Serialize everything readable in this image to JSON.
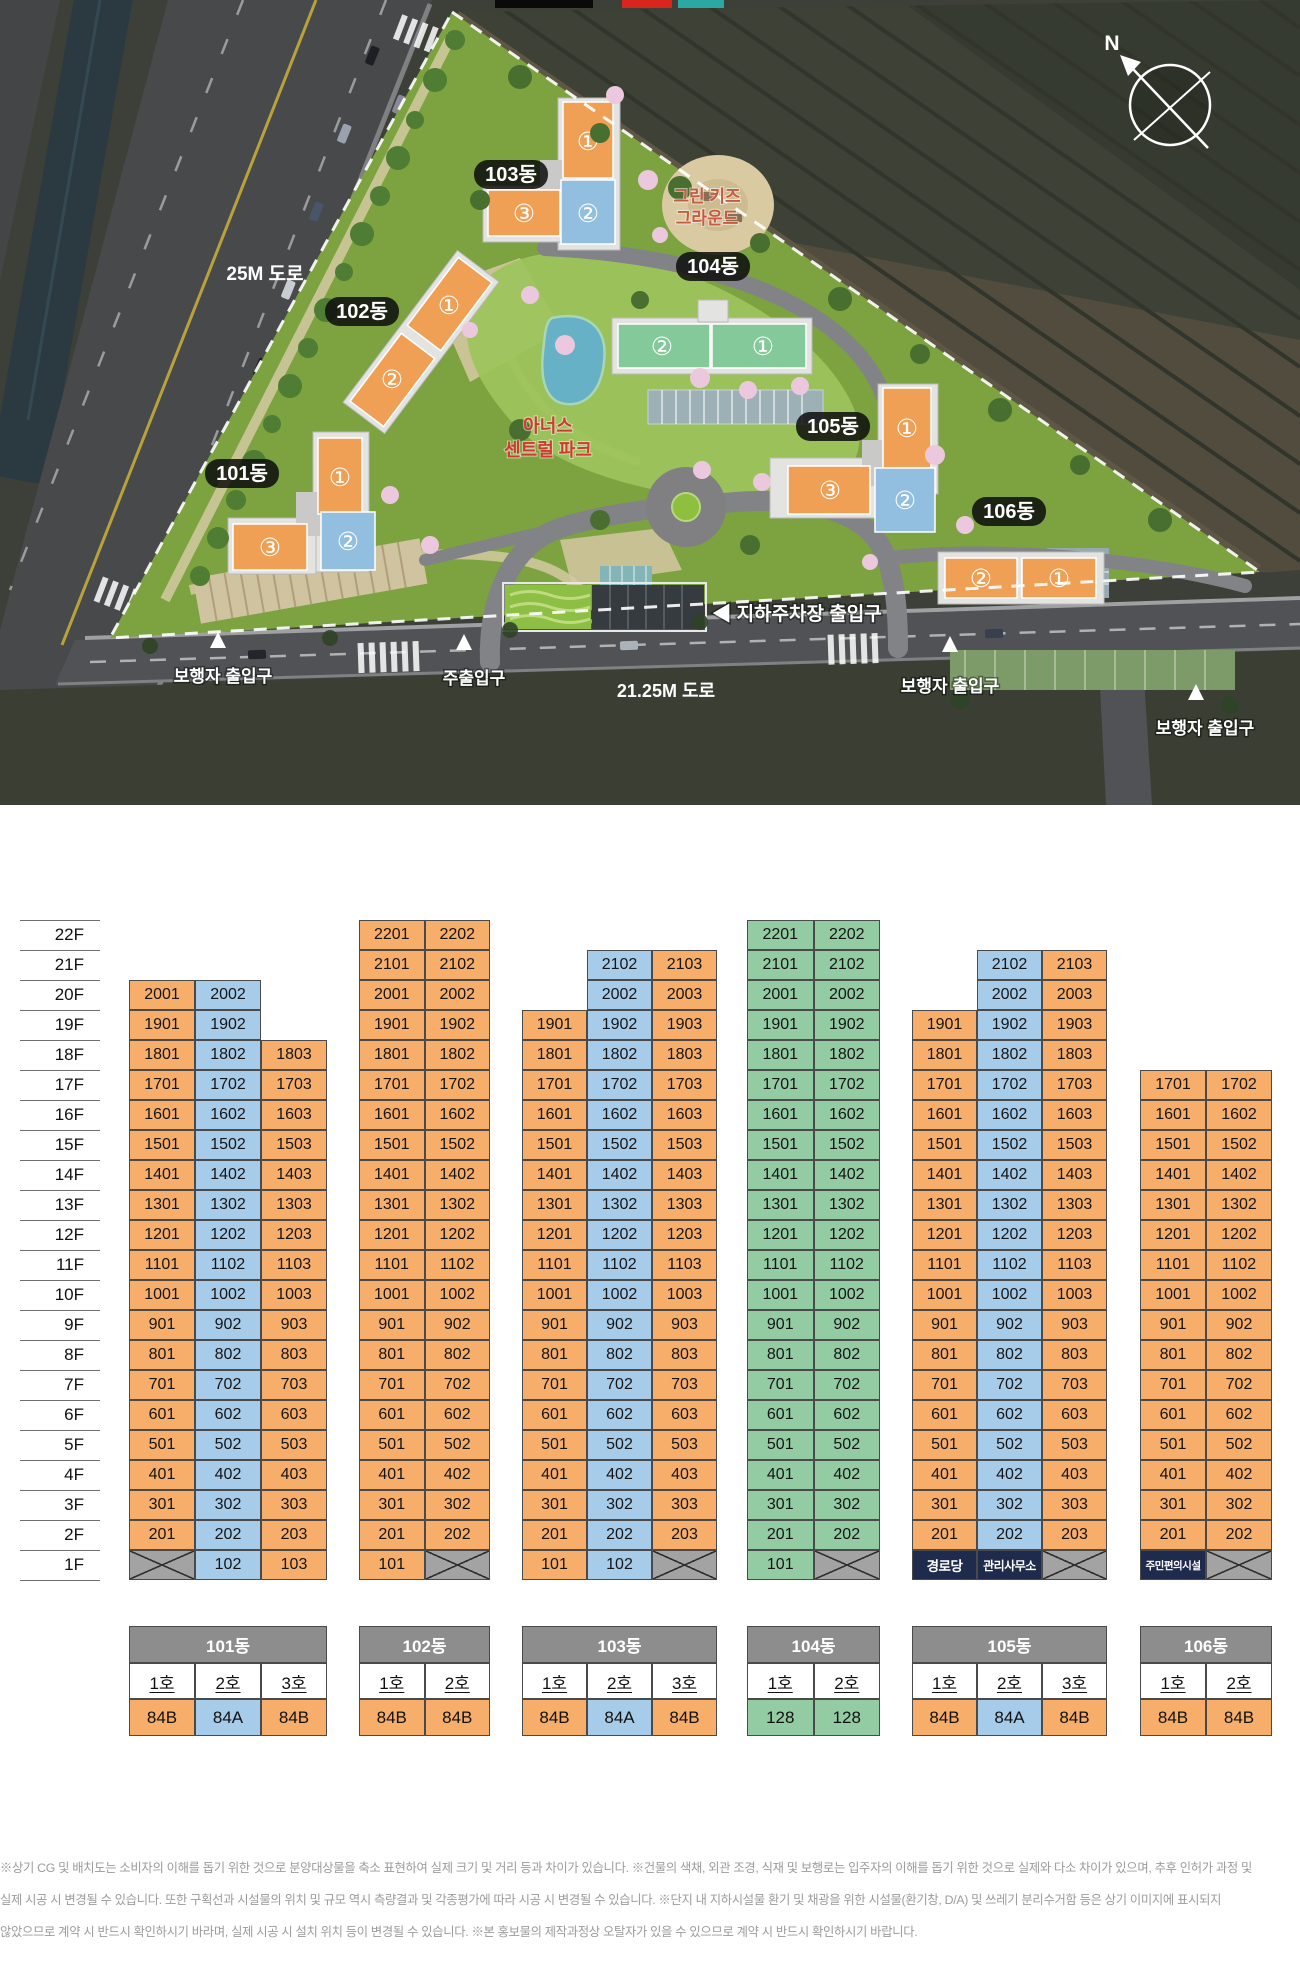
{
  "site_plan": {
    "logo_colors": [
      "#0a0a0a",
      "#d9261c",
      "#2ba8a2"
    ],
    "compass": "N",
    "building_pills": [
      "101동",
      "102동",
      "103동",
      "104동",
      "105동",
      "106동"
    ],
    "circled_units": [
      "①",
      "②",
      "③"
    ],
    "kids_ground": [
      "그린 키즈",
      "그라운드"
    ],
    "central_park": [
      "아너스",
      "센트럴 파크"
    ],
    "road_top": "25M 도로",
    "road_bottom": "21.25M 도로",
    "parking_entrance": "◀ 지하주차장 출입구",
    "pedestrian_entrance": "보행자 출입구",
    "main_entrance": "주출입구"
  },
  "stacking": {
    "palette": {
      "orange": "#f6ae6a",
      "blue": "#a7cce9",
      "green": "#93cba3",
      "gray": "#a3a3a3",
      "navy": "#1f2b4d"
    },
    "floors": [
      "22F",
      "21F",
      "20F",
      "19F",
      "18F",
      "17F",
      "16F",
      "15F",
      "14F",
      "13F",
      "12F",
      "11F",
      "10F",
      "9F",
      "8F",
      "7F",
      "6F",
      "5F",
      "4F",
      "3F",
      "2F",
      "1F"
    ],
    "buildings": [
      {
        "name": "101동",
        "unit_headers": [
          "1호",
          "2호",
          "3호"
        ],
        "types": [
          "84B",
          "84A",
          "84B"
        ],
        "type_colors": [
          "orange",
          "blue",
          "orange"
        ],
        "columns": [
          {
            "top_floor": 20,
            "color": "orange",
            "ground": {
              "kind": "x"
            }
          },
          {
            "top_floor": 20,
            "color": "blue",
            "ground": {
              "kind": "unit",
              "label": "102"
            }
          },
          {
            "top_floor": 18,
            "color": "orange",
            "ground": {
              "kind": "unit",
              "label": "103"
            }
          }
        ]
      },
      {
        "name": "102동",
        "unit_headers": [
          "1호",
          "2호"
        ],
        "types": [
          "84B",
          "84B"
        ],
        "type_colors": [
          "orange",
          "orange"
        ],
        "columns": [
          {
            "top_floor": 22,
            "color": "orange",
            "ground": {
              "kind": "unit",
              "label": "101"
            }
          },
          {
            "top_floor": 22,
            "color": "orange",
            "ground": {
              "kind": "x"
            }
          }
        ]
      },
      {
        "name": "103동",
        "unit_headers": [
          "1호",
          "2호",
          "3호"
        ],
        "types": [
          "84B",
          "84A",
          "84B"
        ],
        "type_colors": [
          "orange",
          "blue",
          "orange"
        ],
        "columns": [
          {
            "top_floor": 19,
            "color": "orange",
            "ground": {
              "kind": "unit",
              "label": "101"
            }
          },
          {
            "top_floor": 21,
            "color": "blue",
            "ground": {
              "kind": "unit",
              "label": "102"
            }
          },
          {
            "top_floor": 21,
            "color": "orange",
            "ground": {
              "kind": "x"
            }
          }
        ]
      },
      {
        "name": "104동",
        "unit_headers": [
          "1호",
          "2호"
        ],
        "types": [
          "128",
          "128"
        ],
        "type_colors": [
          "green",
          "green"
        ],
        "columns": [
          {
            "top_floor": 22,
            "color": "green",
            "ground": {
              "kind": "unit",
              "label": "101"
            }
          },
          {
            "top_floor": 22,
            "color": "green",
            "ground": {
              "kind": "x"
            }
          }
        ]
      },
      {
        "name": "105동",
        "unit_headers": [
          "1호",
          "2호",
          "3호"
        ],
        "types": [
          "84B",
          "84A",
          "84B"
        ],
        "type_colors": [
          "orange",
          "blue",
          "orange"
        ],
        "columns": [
          {
            "top_floor": 19,
            "color": "orange",
            "ground": {
              "kind": "special",
              "label": "경로당"
            }
          },
          {
            "top_floor": 21,
            "color": "blue",
            "ground": {
              "kind": "special",
              "label": "관리사무소"
            }
          },
          {
            "top_floor": 21,
            "color": "orange",
            "ground": {
              "kind": "x"
            }
          }
        ]
      },
      {
        "name": "106동",
        "unit_headers": [
          "1호",
          "2호"
        ],
        "types": [
          "84B",
          "84B"
        ],
        "type_colors": [
          "orange",
          "orange"
        ],
        "columns": [
          {
            "top_floor": 17,
            "color": "orange",
            "ground": {
              "kind": "special",
              "label": "주민편의시설"
            }
          },
          {
            "top_floor": 17,
            "color": "orange",
            "ground": {
              "kind": "x"
            }
          }
        ]
      }
    ]
  },
  "disclaimer": {
    "lines": [
      "※상기 CG 및 배치도는 소비자의 이해를 돕기 위한 것으로 분양대상물을 축소 표현하여 실제 크기 및 거리 등과 차이가 있습니다. ※건물의 색채, 외관 조경, 식재 및 보행로는 입주자의 이해를 돕기 위한 것으로 실제와 다소 차이가 있으며, 추후 인허가 과정 및",
      "실제 시공 시 변경될 수 있습니다. 또한 구획선과 시설물의 위치 및 규모 역시 측량결과 및 각종평가에 따라 시공 시 변경될 수 있습니다. ※단지 내 지하시설물 환기 및 채광을 위한 시설물(환기창, D/A) 및 쓰레기 분리수거함 등은 상기 이미지에 표시되지",
      "않았으므로 계약 시 반드시 확인하시기 바라며, 실제 시공 시 설치 위치 등이 변경될 수 있습니다. ※본 홍보물의 제작과정상 오탈자가 있을 수 있으므로 계약 시 반드시 확인하시기 바랍니다."
    ]
  }
}
